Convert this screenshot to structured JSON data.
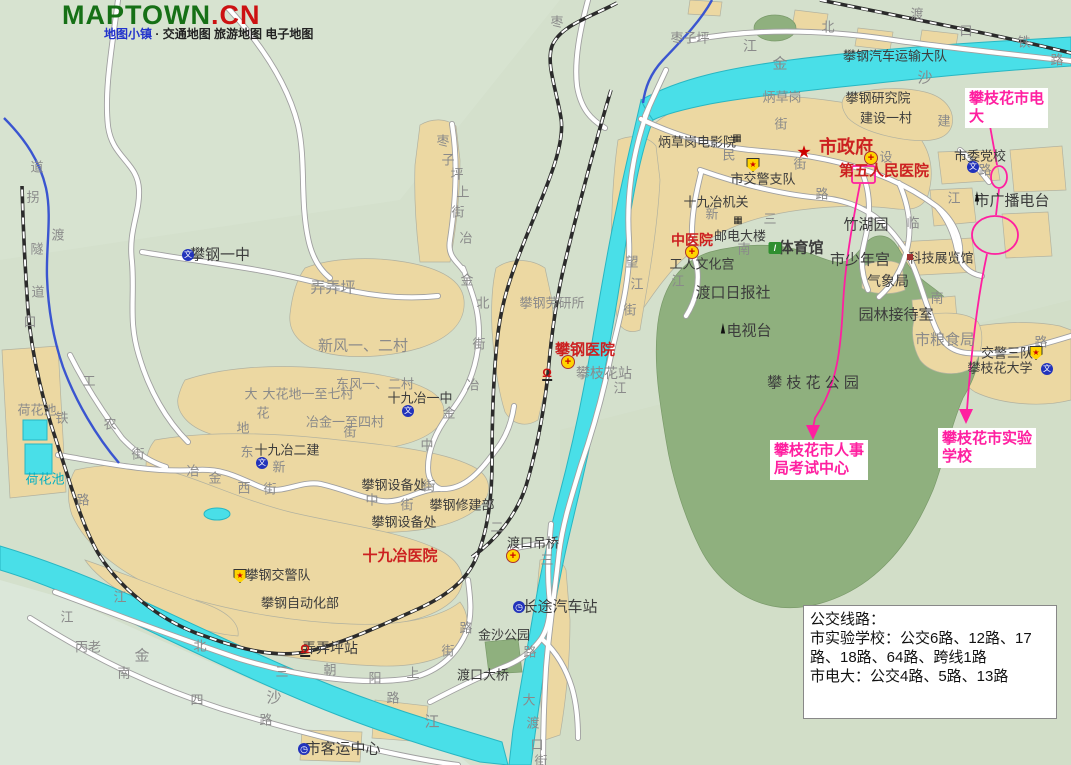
{
  "header": {
    "logo_green": "MAPTOWN",
    "logo_red": ".CN",
    "tagline_brand": "地图小镇",
    "tagline_sep": "·",
    "tagline_rest": "交通地图 旅游地图 电子地图"
  },
  "colors": {
    "background": "#d4e0cc",
    "builtup": "#ecd8a2",
    "park": "#8fb07e",
    "river": "#49dfe8",
    "annotation_pink": "#ff1fa0",
    "logo_green": "#167016",
    "logo_red": "#cc1111",
    "red_label": "#cc2020"
  },
  "map": {
    "icon_glyphs": {
      "star": "★",
      "hospital": "+",
      "police": "★",
      "school": "文",
      "bus": "◷",
      "station": "Ω",
      "tower": "▲",
      "cinema": "▦",
      "building": "▦",
      "sport": "/",
      "reddot": ""
    },
    "labels": [
      {
        "t": "枣",
        "x": 557,
        "y": 22,
        "c": "street"
      },
      {
        "t": "枣子坪",
        "x": 690,
        "y": 38,
        "c": "street"
      },
      {
        "t": "江",
        "x": 750,
        "y": 46,
        "c": "street",
        "s": 14
      },
      {
        "t": "金",
        "x": 780,
        "y": 64,
        "c": "street",
        "s": 15
      },
      {
        "t": "沙",
        "x": 925,
        "y": 78,
        "c": "street",
        "s": 15
      },
      {
        "t": "北",
        "x": 828,
        "y": 27,
        "c": "street"
      },
      {
        "t": "渡",
        "x": 917,
        "y": 14,
        "c": "street"
      },
      {
        "t": "口",
        "x": 966,
        "y": 31,
        "c": "street"
      },
      {
        "t": "铁",
        "x": 1024,
        "y": 42,
        "c": "street"
      },
      {
        "t": "路",
        "x": 1057,
        "y": 60,
        "c": "street"
      },
      {
        "t": "攀钢汽车运输大队",
        "x": 895,
        "y": 56,
        "c": "place"
      },
      {
        "t": "炳草岗",
        "x": 782,
        "y": 97,
        "c": "street"
      },
      {
        "t": "攀钢研究院",
        "x": 878,
        "y": 98,
        "c": "place"
      },
      {
        "t": "建设一村",
        "x": 886,
        "y": 118,
        "c": "place"
      },
      {
        "t": "建",
        "x": 944,
        "y": 121,
        "c": "street"
      },
      {
        "t": "炳草岗电影院",
        "x": 697,
        "y": 142,
        "c": "place"
      },
      {
        "t": "民",
        "x": 729,
        "y": 155,
        "c": "street"
      },
      {
        "t": "街",
        "x": 781,
        "y": 124,
        "c": "street"
      },
      {
        "t": "市政府",
        "x": 846,
        "y": 147,
        "c": "red",
        "s": 18,
        "b": 1
      },
      {
        "t": "街",
        "x": 800,
        "y": 164,
        "c": "street"
      },
      {
        "t": "设",
        "x": 886,
        "y": 157,
        "c": "street"
      },
      {
        "t": "第五人民医院",
        "x": 884,
        "y": 171,
        "c": "red",
        "s": 15,
        "b": 1
      },
      {
        "t": "市交警支队",
        "x": 763,
        "y": 179,
        "c": "place"
      },
      {
        "t": "十九冶机关",
        "x": 716,
        "y": 202,
        "c": "place"
      },
      {
        "t": "新",
        "x": 712,
        "y": 214,
        "c": "street"
      },
      {
        "t": "三",
        "x": 770,
        "y": 219,
        "c": "street"
      },
      {
        "t": "路",
        "x": 822,
        "y": 194,
        "c": "street"
      },
      {
        "t": "邮电大楼",
        "x": 740,
        "y": 236,
        "c": "place"
      },
      {
        "t": "南",
        "x": 744,
        "y": 249,
        "c": "street"
      },
      {
        "t": "中医院",
        "x": 692,
        "y": 240,
        "c": "red",
        "s": 14,
        "b": 1
      },
      {
        "t": "工人文化宫",
        "x": 702,
        "y": 264,
        "c": "place"
      },
      {
        "t": "江",
        "x": 678,
        "y": 281,
        "c": "street"
      },
      {
        "t": "体育馆",
        "x": 801,
        "y": 248,
        "c": "place",
        "s": 15,
        "b": 1
      },
      {
        "t": "竹湖园",
        "x": 866,
        "y": 225,
        "c": "place",
        "s": 15
      },
      {
        "t": "市少年宫",
        "x": 860,
        "y": 260,
        "c": "place",
        "s": 15
      },
      {
        "t": "临",
        "x": 913,
        "y": 223,
        "c": "street"
      },
      {
        "t": "江",
        "x": 954,
        "y": 198,
        "c": "street"
      },
      {
        "t": "市委党校",
        "x": 980,
        "y": 156,
        "c": "place"
      },
      {
        "t": "路",
        "x": 985,
        "y": 170,
        "c": "street"
      },
      {
        "t": "市广播电台",
        "x": 1012,
        "y": 201,
        "c": "place",
        "s": 15
      },
      {
        "t": "科技展览馆",
        "x": 941,
        "y": 258,
        "c": "place"
      },
      {
        "t": "气象局",
        "x": 888,
        "y": 281,
        "c": "place",
        "s": 14
      },
      {
        "t": "园林接待室",
        "x": 896,
        "y": 315,
        "c": "place",
        "s": 15
      },
      {
        "t": "市粮食局",
        "x": 945,
        "y": 340,
        "c": "street",
        "s": 15
      },
      {
        "t": "南",
        "x": 937,
        "y": 298,
        "c": "street"
      },
      {
        "t": "渡口日报社",
        "x": 733,
        "y": 293,
        "c": "place",
        "s": 15
      },
      {
        "t": "电视台",
        "x": 749,
        "y": 331,
        "c": "place",
        "s": 15
      },
      {
        "t": "攀 枝 花 公 园",
        "x": 813,
        "y": 383,
        "c": "place",
        "s": 15
      },
      {
        "t": "交警三队",
        "x": 1007,
        "y": 353,
        "c": "place"
      },
      {
        "t": "攀枝花大学",
        "x": 1000,
        "y": 368,
        "c": "place"
      },
      {
        "t": "路",
        "x": 1041,
        "y": 342,
        "c": "street"
      },
      {
        "t": "攀钢劳研所",
        "x": 552,
        "y": 303,
        "c": "street"
      },
      {
        "t": "攀钢医院",
        "x": 585,
        "y": 350,
        "c": "red",
        "s": 15,
        "b": 1
      },
      {
        "t": "攀枝花站",
        "x": 604,
        "y": 373,
        "c": "street",
        "s": 14
      },
      {
        "t": "望",
        "x": 632,
        "y": 262,
        "c": "street"
      },
      {
        "t": "江",
        "x": 637,
        "y": 284,
        "c": "street"
      },
      {
        "t": "街",
        "x": 630,
        "y": 310,
        "c": "street"
      },
      {
        "t": "江",
        "x": 620,
        "y": 388,
        "c": "street"
      },
      {
        "t": "枣",
        "x": 443,
        "y": 141,
        "c": "street"
      },
      {
        "t": "子",
        "x": 448,
        "y": 160,
        "c": "street"
      },
      {
        "t": "坪",
        "x": 457,
        "y": 174,
        "c": "street"
      },
      {
        "t": "上",
        "x": 463,
        "y": 192,
        "c": "street"
      },
      {
        "t": "街",
        "x": 458,
        "y": 212,
        "c": "street"
      },
      {
        "t": "冶",
        "x": 466,
        "y": 238,
        "c": "street"
      },
      {
        "t": "金",
        "x": 467,
        "y": 280,
        "c": "street"
      },
      {
        "t": "北",
        "x": 483,
        "y": 303,
        "c": "street"
      },
      {
        "t": "街",
        "x": 479,
        "y": 344,
        "c": "street"
      },
      {
        "t": "冶",
        "x": 473,
        "y": 385,
        "c": "street"
      },
      {
        "t": "金",
        "x": 449,
        "y": 413,
        "c": "street"
      },
      {
        "t": "中",
        "x": 427,
        "y": 445,
        "c": "street"
      },
      {
        "t": "街",
        "x": 350,
        "y": 432,
        "c": "street"
      },
      {
        "t": "道",
        "x": 37,
        "y": 167,
        "c": "street"
      },
      {
        "t": "拐",
        "x": 33,
        "y": 197,
        "c": "street"
      },
      {
        "t": "渡",
        "x": 58,
        "y": 235,
        "c": "street"
      },
      {
        "t": "隧",
        "x": 37,
        "y": 249,
        "c": "street"
      },
      {
        "t": "道",
        "x": 38,
        "y": 292,
        "c": "street"
      },
      {
        "t": "口",
        "x": 30,
        "y": 322,
        "c": "street"
      },
      {
        "t": "攀钢一中",
        "x": 220,
        "y": 255,
        "c": "place",
        "s": 15
      },
      {
        "t": "弄弄坪",
        "x": 333,
        "y": 288,
        "c": "street",
        "s": 15
      },
      {
        "t": "新风一、二村",
        "x": 363,
        "y": 346,
        "c": "street",
        "s": 15
      },
      {
        "t": "东风一、二村",
        "x": 375,
        "y": 384,
        "c": "street"
      },
      {
        "t": "大",
        "x": 251,
        "y": 394,
        "c": "street"
      },
      {
        "t": "大花地一至七村",
        "x": 308,
        "y": 394,
        "c": "street"
      },
      {
        "t": "花",
        "x": 263,
        "y": 413,
        "c": "street"
      },
      {
        "t": "地",
        "x": 243,
        "y": 428,
        "c": "street"
      },
      {
        "t": "十九冶一中",
        "x": 420,
        "y": 398,
        "c": "place"
      },
      {
        "t": "冶金一至四村",
        "x": 345,
        "y": 422,
        "c": "street"
      },
      {
        "t": "十九冶二建",
        "x": 287,
        "y": 450,
        "c": "place"
      },
      {
        "t": "新",
        "x": 279,
        "y": 467,
        "c": "street"
      },
      {
        "t": "东",
        "x": 247,
        "y": 452,
        "c": "street"
      },
      {
        "t": "工",
        "x": 89,
        "y": 381,
        "c": "street"
      },
      {
        "t": "农",
        "x": 110,
        "y": 424,
        "c": "street"
      },
      {
        "t": "街",
        "x": 138,
        "y": 454,
        "c": "street"
      },
      {
        "t": "铁",
        "x": 62,
        "y": 418,
        "c": "street"
      },
      {
        "t": "路",
        "x": 83,
        "y": 500,
        "c": "street"
      },
      {
        "t": "荷花池",
        "x": 37,
        "y": 410,
        "c": "street"
      },
      {
        "t": "荷花池",
        "x": 45,
        "y": 479,
        "c": "water"
      },
      {
        "t": "冶",
        "x": 193,
        "y": 471,
        "c": "street"
      },
      {
        "t": "金",
        "x": 215,
        "y": 478,
        "c": "street"
      },
      {
        "t": "西",
        "x": 244,
        "y": 488,
        "c": "street"
      },
      {
        "t": "街",
        "x": 270,
        "y": 489,
        "c": "street"
      },
      {
        "t": "攀钢设备处",
        "x": 394,
        "y": 485,
        "c": "place"
      },
      {
        "t": "街",
        "x": 429,
        "y": 486,
        "c": "street"
      },
      {
        "t": "中",
        "x": 372,
        "y": 500,
        "c": "street"
      },
      {
        "t": "街",
        "x": 407,
        "y": 505,
        "c": "street"
      },
      {
        "t": "攀钢修建部",
        "x": 462,
        "y": 505,
        "c": "place"
      },
      {
        "t": "攀钢设备处",
        "x": 404,
        "y": 522,
        "c": "place"
      },
      {
        "t": "十九冶医院",
        "x": 400,
        "y": 556,
        "c": "red",
        "s": 15,
        "b": 1
      },
      {
        "t": "攀钢交警队",
        "x": 278,
        "y": 575,
        "c": "place"
      },
      {
        "t": "攀钢自动化部",
        "x": 300,
        "y": 603,
        "c": "place"
      },
      {
        "t": "弄弄坪站",
        "x": 330,
        "y": 648,
        "c": "place",
        "s": 14
      },
      {
        "t": "二",
        "x": 497,
        "y": 527,
        "c": "street"
      },
      {
        "t": "渡口吊桥",
        "x": 533,
        "y": 543,
        "c": "place"
      },
      {
        "t": "三",
        "x": 547,
        "y": 560,
        "c": "street"
      },
      {
        "t": "长途汽车站",
        "x": 560,
        "y": 607,
        "c": "place",
        "s": 15
      },
      {
        "t": "金沙公园",
        "x": 504,
        "y": 635,
        "c": "place"
      },
      {
        "t": "路",
        "x": 530,
        "y": 652,
        "c": "street"
      },
      {
        "t": "渡口大桥",
        "x": 483,
        "y": 675,
        "c": "place"
      },
      {
        "t": "北",
        "x": 200,
        "y": 646,
        "c": "street"
      },
      {
        "t": "三",
        "x": 282,
        "y": 672,
        "c": "street"
      },
      {
        "t": "朝",
        "x": 330,
        "y": 670,
        "c": "street"
      },
      {
        "t": "阳",
        "x": 375,
        "y": 678,
        "c": "street"
      },
      {
        "t": "上",
        "x": 413,
        "y": 673,
        "c": "street"
      },
      {
        "t": "路",
        "x": 393,
        "y": 698,
        "c": "street"
      },
      {
        "t": "街",
        "x": 448,
        "y": 651,
        "c": "street"
      },
      {
        "t": "路",
        "x": 466,
        "y": 628,
        "c": "street"
      },
      {
        "t": "四",
        "x": 197,
        "y": 700,
        "c": "street"
      },
      {
        "t": "路",
        "x": 266,
        "y": 720,
        "c": "street"
      },
      {
        "t": "金",
        "x": 142,
        "y": 656,
        "c": "street",
        "s": 15
      },
      {
        "t": "沙",
        "x": 274,
        "y": 698,
        "c": "street",
        "s": 15
      },
      {
        "t": "江",
        "x": 432,
        "y": 722,
        "c": "street",
        "s": 15
      },
      {
        "t": "南",
        "x": 124,
        "y": 673,
        "c": "street"
      },
      {
        "t": "丙老",
        "x": 88,
        "y": 647,
        "c": "street"
      },
      {
        "t": "江",
        "x": 67,
        "y": 617,
        "c": "street"
      },
      {
        "t": "江",
        "x": 120,
        "y": 597,
        "c": "street"
      },
      {
        "t": "市客运中心",
        "x": 343,
        "y": 749,
        "c": "place",
        "s": 15
      },
      {
        "t": "大",
        "x": 529,
        "y": 700,
        "c": "street"
      },
      {
        "t": "渡",
        "x": 533,
        "y": 723,
        "c": "street"
      },
      {
        "t": "口",
        "x": 537,
        "y": 745,
        "c": "street"
      },
      {
        "t": "街",
        "x": 541,
        "y": 761,
        "c": "street"
      }
    ],
    "pois": [
      {
        "type": "star",
        "x": 804,
        "y": 152
      },
      {
        "type": "hospital",
        "x": 871,
        "y": 158
      },
      {
        "type": "hospital",
        "x": 692,
        "y": 252
      },
      {
        "type": "hospital",
        "x": 568,
        "y": 362
      },
      {
        "type": "hospital",
        "x": 513,
        "y": 556
      },
      {
        "type": "police",
        "x": 753,
        "y": 165
      },
      {
        "type": "police",
        "x": 240,
        "y": 576
      },
      {
        "type": "police",
        "x": 1036,
        "y": 353
      },
      {
        "type": "school",
        "x": 188,
        "y": 255
      },
      {
        "type": "school",
        "x": 408,
        "y": 411
      },
      {
        "type": "school",
        "x": 262,
        "y": 463
      },
      {
        "type": "school",
        "x": 973,
        "y": 167
      },
      {
        "type": "school",
        "x": 1047,
        "y": 369
      },
      {
        "type": "bus",
        "x": 519,
        "y": 607
      },
      {
        "type": "bus",
        "x": 304,
        "y": 749
      },
      {
        "type": "station",
        "x": 547,
        "y": 374
      },
      {
        "type": "station",
        "x": 305,
        "y": 650
      },
      {
        "type": "tower",
        "x": 977,
        "y": 198
      },
      {
        "type": "tower",
        "x": 723,
        "y": 330
      },
      {
        "type": "cinema",
        "x": 737,
        "y": 139
      },
      {
        "type": "building",
        "x": 738,
        "y": 221
      },
      {
        "type": "sport",
        "x": 775,
        "y": 248
      },
      {
        "type": "reddot",
        "x": 910,
        "y": 257
      }
    ],
    "annotations": {
      "dianda": {
        "line1": "攀枝花市电",
        "line2": "大",
        "x": 965,
        "y": 88
      },
      "renshi": {
        "line1": "攀枝花市人事",
        "line2": "局考试中心",
        "x": 770,
        "y": 440
      },
      "shiyan": {
        "line1": "攀枝花市实验",
        "line2": "学校",
        "x": 938,
        "y": 428
      }
    },
    "infobox": {
      "line1": "公交线路：",
      "line2": "市实验学校：公交6路、12路、17",
      "line3": "路、18路、64路、跨线1路",
      "line4": "市电大：公交4路、5路、13路"
    }
  }
}
